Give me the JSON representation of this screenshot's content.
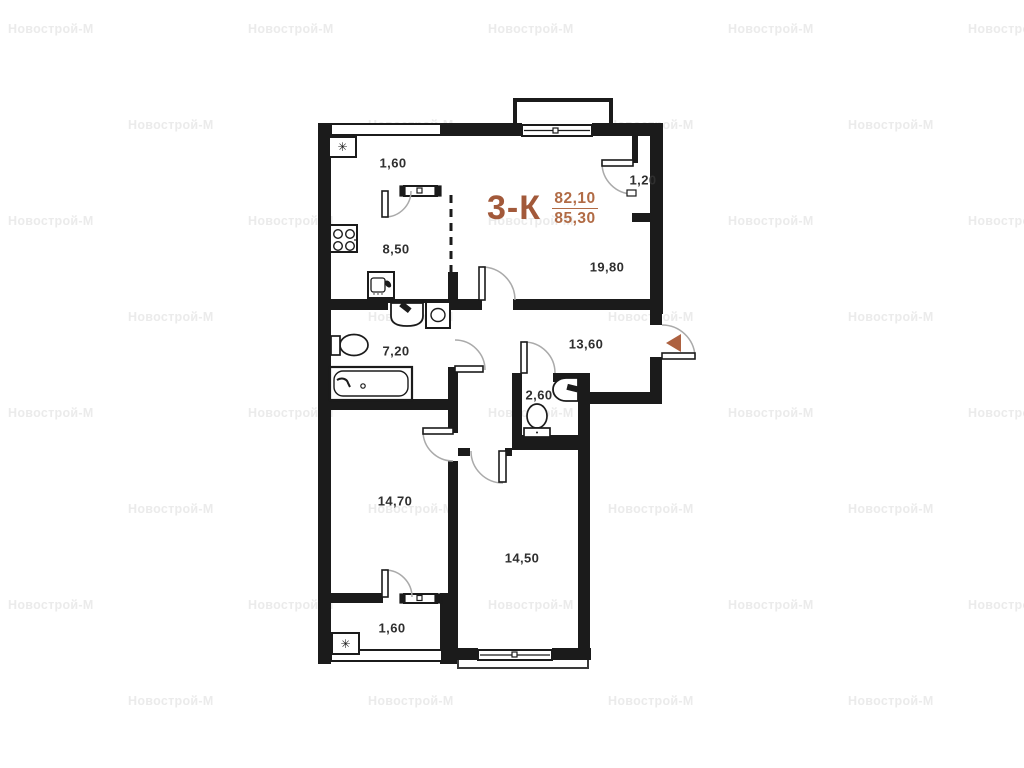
{
  "watermark": {
    "text": "Новострой-М",
    "color": "#ebebeb",
    "rows_y": [
      22,
      118,
      214,
      310,
      406,
      502,
      598,
      694
    ],
    "row_offsets": [
      8,
      128
    ],
    "step": 240,
    "columns": 5
  },
  "title": {
    "type_label": "3-К",
    "area_upper": "82,10",
    "area_lower": "85,30"
  },
  "colors": {
    "wall": "#1b1b1b",
    "accent": "#a2593a",
    "accent_light": "#b16b45",
    "entry_arrow": "#ad6140",
    "watermark": "#ebebeb"
  },
  "icons": {
    "snowflake": "✳"
  },
  "rooms": [
    {
      "id": "balcony-top",
      "area": "1,60",
      "x": 393,
      "y": 163
    },
    {
      "id": "kitchen",
      "area": "8,50",
      "x": 396,
      "y": 249
    },
    {
      "id": "wardrobe",
      "area": "1,20",
      "x": 643,
      "y": 180
    },
    {
      "id": "living-room",
      "area": "19,80",
      "x": 607,
      "y": 267
    },
    {
      "id": "hallway",
      "area": "13,60",
      "x": 586,
      "y": 344
    },
    {
      "id": "bathroom",
      "area": "7,20",
      "x": 396,
      "y": 351
    },
    {
      "id": "wc",
      "area": "2,60",
      "x": 539,
      "y": 395
    },
    {
      "id": "bedroom-left",
      "area": "14,70",
      "x": 395,
      "y": 501
    },
    {
      "id": "bedroom-right",
      "area": "14,50",
      "x": 522,
      "y": 558
    },
    {
      "id": "balcony-bottom",
      "area": "1,60",
      "x": 392,
      "y": 628
    }
  ]
}
